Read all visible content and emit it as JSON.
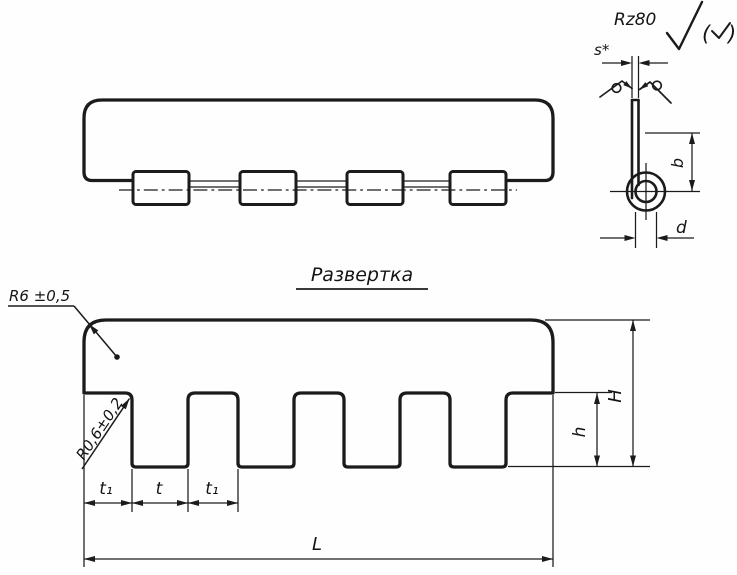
{
  "surface_note": {
    "rz_value": "Rz80",
    "paren_open": "(",
    "paren_close": ")"
  },
  "section_view": {
    "thickness_label": "s*",
    "height_label": "b",
    "diameter_label": "d"
  },
  "development_view": {
    "title": "Развертка",
    "corner_radius_label": "R6 ±0,5",
    "slot_radius_label": "R0,6±0,2",
    "pitch_left_label": "t₁",
    "tooth_label": "t",
    "pitch_right_label": "t₁",
    "length_label": "L",
    "tooth_height_label": "h",
    "total_height_label": "H"
  }
}
